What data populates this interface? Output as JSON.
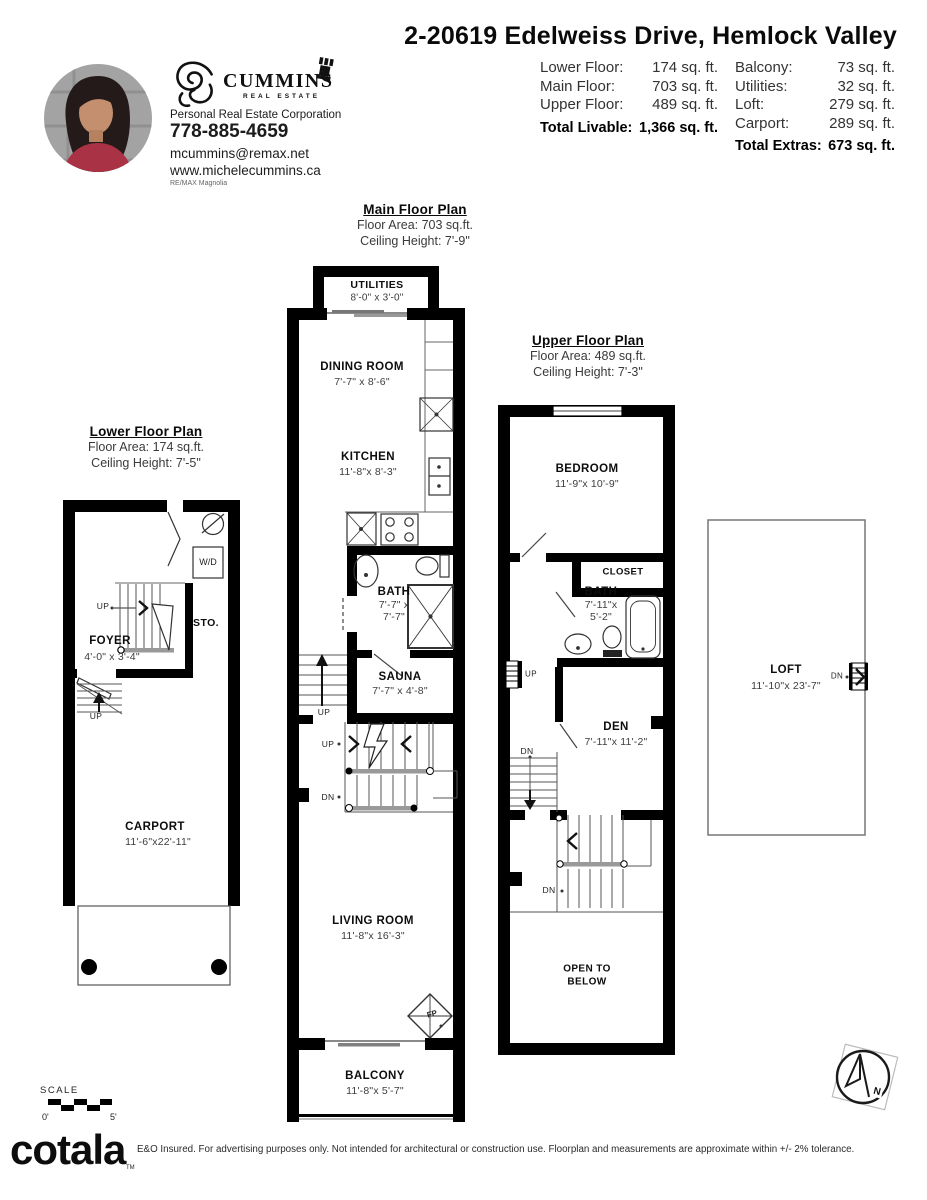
{
  "header": {
    "title": "2-20619 Edelweiss Drive, Hemlock Valley",
    "agent": {
      "brand": "CUMMINS",
      "brand_sub": "REAL ESTATE",
      "designation": "Personal Real Estate Corporation",
      "phone": "778-885-4659",
      "email": "mcummins@remax.net",
      "website": "www.michelecummins.ca",
      "brokerage": "RE/MAX Magnolia"
    }
  },
  "areas": {
    "left": [
      {
        "label": "Lower Floor:",
        "value": "174 sq. ft."
      },
      {
        "label": "Main Floor:",
        "value": "703 sq. ft."
      },
      {
        "label": "Upper Floor:",
        "value": "489 sq. ft."
      }
    ],
    "left_total_label": "Total Livable:",
    "left_total_value": "1,366 sq. ft.",
    "right": [
      {
        "label": "Balcony:",
        "value": "73 sq. ft."
      },
      {
        "label": "Utilities:",
        "value": "32 sq. ft."
      },
      {
        "label": "Loft:",
        "value": "279 sq. ft."
      },
      {
        "label": "Carport:",
        "value": "289 sq. ft."
      }
    ],
    "right_total_label": "Total Extras:",
    "right_total_value": "673 sq. ft."
  },
  "plans": {
    "main": {
      "title": "Main Floor Plan",
      "area_line": "Floor Area: 703 sq.ft.",
      "ceiling_line": "Ceiling Height: 7'-9\"",
      "rooms": {
        "utilities": {
          "name": "UTILITIES",
          "dims": "8'-0\" x 3'-0\""
        },
        "dining": {
          "name": "DINING ROOM",
          "dims": "7'-7\" x 8'-6\""
        },
        "kitchen": {
          "name": "KITCHEN",
          "dims": "11'-8\"x 8'-3\""
        },
        "bath": {
          "name": "BATH",
          "dims": "7'-7\" x",
          "dims2": "7'-7\""
        },
        "sauna": {
          "name": "SAUNA",
          "dims": "7'-7\" x 4'-8\""
        },
        "living": {
          "name": "LIVING ROOM",
          "dims": "11'-8\"x 16'-3\""
        },
        "balcony": {
          "name": "BALCONY",
          "dims": "11'-8\"x 5'-7\""
        }
      }
    },
    "lower": {
      "title": "Lower Floor Plan",
      "area_line": "Floor Area: 174 sq.ft.",
      "ceiling_line": "Ceiling Height: 7'-5\"",
      "rooms": {
        "foyer": {
          "name": "FOYER",
          "dims": "4'-0\" x 3'-4\""
        },
        "storage": {
          "name": "STO."
        },
        "carport": {
          "name": "CARPORT",
          "dims": "11'-6\"x22'-11\""
        }
      }
    },
    "upper": {
      "title": "Upper Floor Plan",
      "area_line": "Floor Area: 489 sq.ft.",
      "ceiling_line": "Ceiling Height: 7'-3\"",
      "rooms": {
        "bedroom": {
          "name": "BEDROOM",
          "dims": "11'-9\"x 10'-9\""
        },
        "closet": {
          "name": "CLOSET"
        },
        "bath": {
          "name": "BATH",
          "dims": "7'-11\"x",
          "dims2": "5'-2\""
        },
        "den": {
          "name": "DEN",
          "dims": "7'-11\"x 11'-2\""
        },
        "open_below_1": "OPEN TO",
        "open_below_2": "BELOW"
      }
    },
    "loft": {
      "name": "LOFT",
      "dims": "11'-10\"x 23'-7\""
    }
  },
  "markers": {
    "up": "UP",
    "dn": "DN",
    "fp": "FP",
    "wd": "W/D",
    "north": "N"
  },
  "scale": {
    "label": "SCALE",
    "start": "0'",
    "end": "5'"
  },
  "footer": {
    "logo": "cotala",
    "tm": "TM",
    "disclaimer": "E&O Insured. For advertising purposes only. Not intended for architectural or construction use. Floorplan and measurements are approximate within +/- 2% tolerance."
  },
  "colors": {
    "ink": "#000000",
    "muted": "#3d3d3d",
    "blazer": "#a93344"
  }
}
